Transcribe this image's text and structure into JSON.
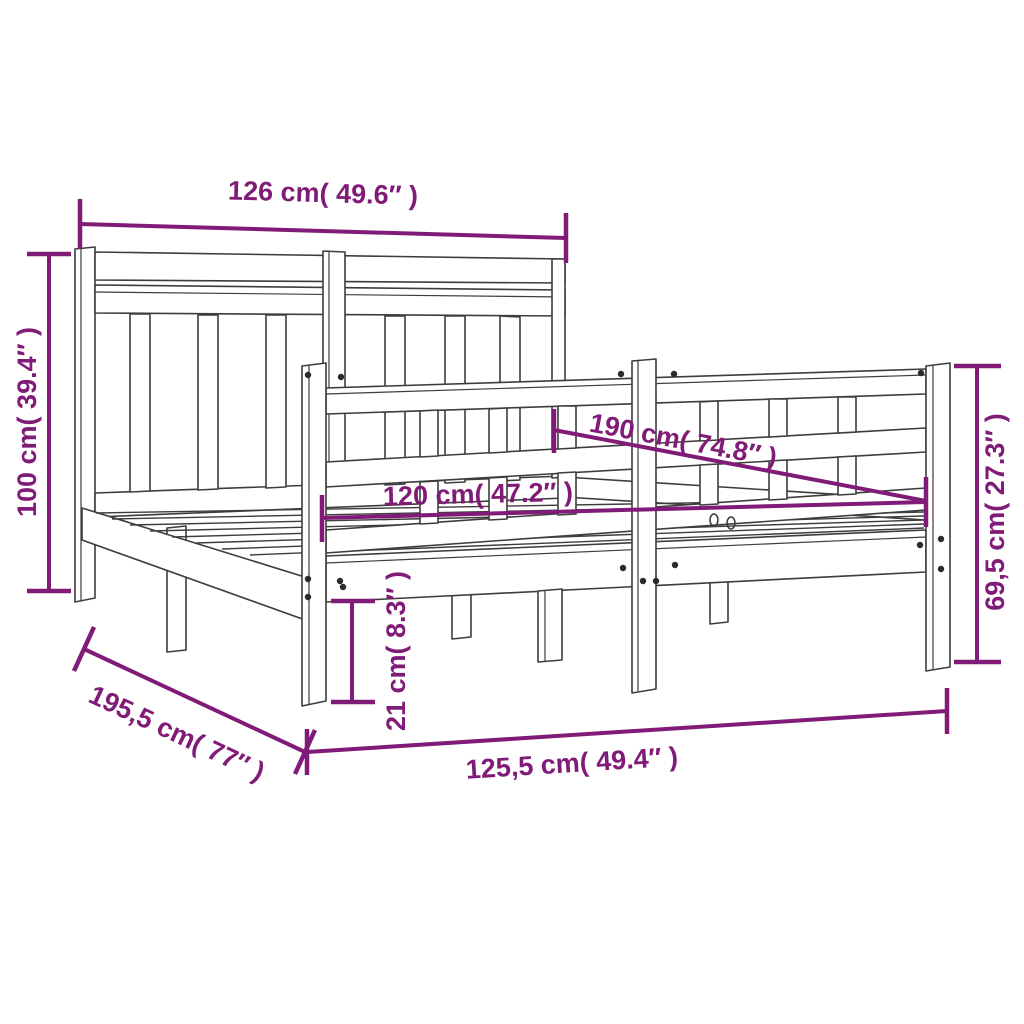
{
  "colors": {
    "dimension": "#811B78",
    "drawing": "#3D3D3D",
    "background": "#FFFFFF",
    "screw": "#2B2B2B"
  },
  "dimensions": {
    "headboard_width": {
      "label": "126 cm( 49.6″ )",
      "cm": "126",
      "inch": "49.6"
    },
    "headboard_height": {
      "label": "100 cm( 39.4″ )",
      "cm": "100",
      "inch": "39.4"
    },
    "bed_length_inner": {
      "label": "190 cm( 74.8″ )",
      "cm": "190",
      "inch": "74.8"
    },
    "bed_width_inner": {
      "label": "120 cm( 47.2″ )",
      "cm": "120",
      "inch": "47.2"
    },
    "footboard_height": {
      "label": "69,5 cm( 27.3″ )",
      "cm": "69,5",
      "inch": "27.3"
    },
    "frame_base_height": {
      "label": "21 cm( 8.3″ )",
      "cm": "21",
      "inch": "8.3"
    },
    "total_length": {
      "label": "195,5 cm( 77″ )",
      "cm": "195,5",
      "inch": "77"
    },
    "total_width": {
      "label": "125,5 cm( 49.4″ )",
      "cm": "125,5",
      "inch": "49.4"
    }
  }
}
